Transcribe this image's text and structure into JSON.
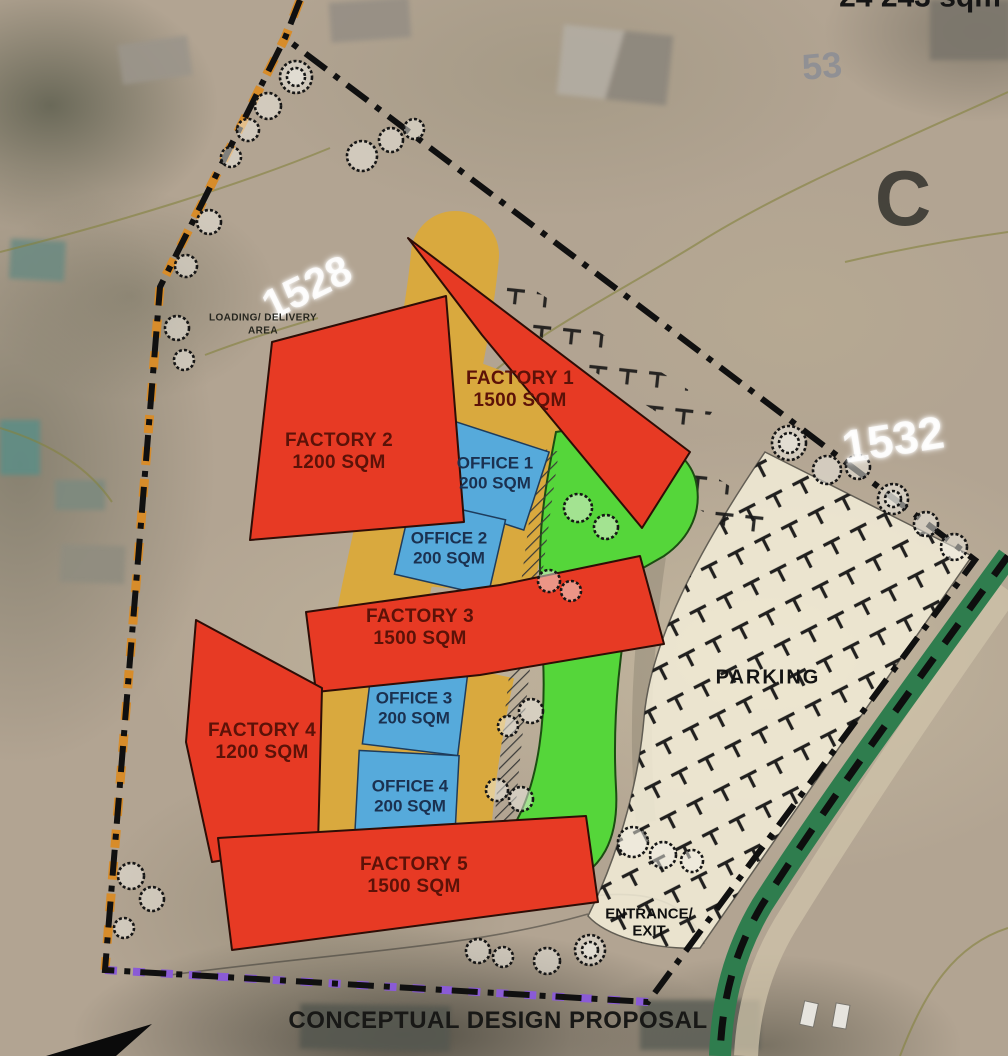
{
  "annotations": {
    "site_area": "24 243 sqm",
    "section_letter": "C",
    "proposal_title": "CONCEPTUAL DESIGN PROPOSAL",
    "label_1528": "1528",
    "label_1532": "1532",
    "label_53": "53"
  },
  "plan": {
    "factories": [
      {
        "name": "FACTORY 1",
        "area": "1500 SQM"
      },
      {
        "name": "FACTORY 2",
        "area": "1200 SQM"
      },
      {
        "name": "FACTORY 3",
        "area": "1500 SQM"
      },
      {
        "name": "FACTORY 4",
        "area": "1200 SQM"
      },
      {
        "name": "FACTORY 5",
        "area": "1500 SQM"
      }
    ],
    "offices": [
      {
        "name": "OFFICE 1",
        "area": "200 SQM"
      },
      {
        "name": "OFFICE 2",
        "area": "200 SQM"
      },
      {
        "name": "OFFICE 3",
        "area": "200 SQM"
      },
      {
        "name": "OFFICE 4",
        "area": "200 SQM"
      }
    ],
    "parking_label": "PARKING",
    "loading_area_label": "LOADING/ DELIVERY AREA",
    "entrance_label": "ENTRANCE/ EXIT"
  },
  "colors": {
    "factory_fill": "#e73a24",
    "office_fill": "#56aadb",
    "road_fill": "#d9a93e",
    "landscape_fill": "#55d63a",
    "parking_fill": "#f4eed9",
    "boundary_black": "#101010",
    "boundary_orange": "#d78c2a",
    "boundary_purple": "#8a5bd6",
    "verge_green": "#2f7d4e",
    "factory_text": "#5c1208",
    "office_text": "#1b3150"
  }
}
